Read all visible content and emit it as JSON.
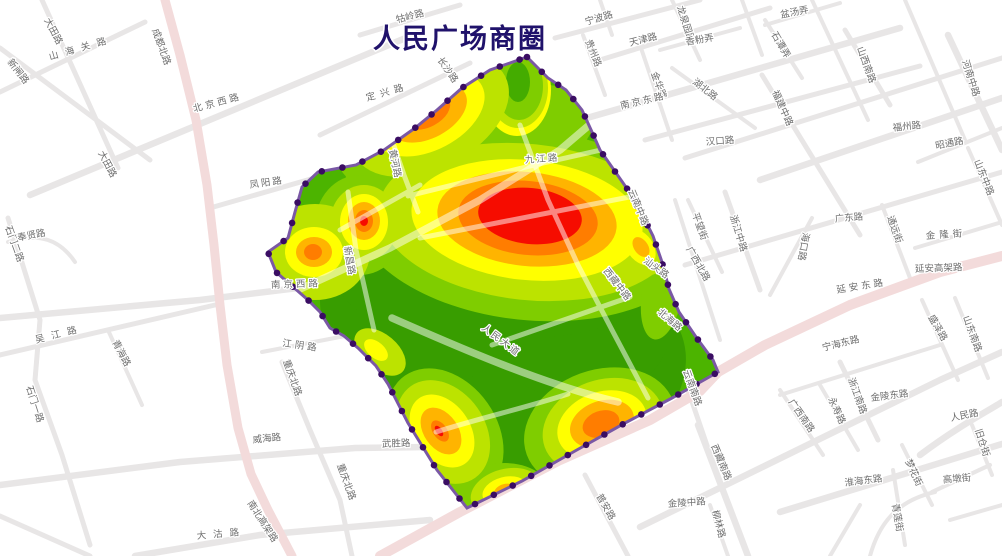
{
  "title": {
    "text": "人民广场商圈",
    "color": "#20126B"
  },
  "map": {
    "background": "#FFFFFF",
    "road_color": "#E8E6E6",
    "major_road_color": "#F3DBDB",
    "inner_road_color": "rgba(255,255,255,0.5)",
    "label_color": "#6E6E6E",
    "boundary": {
      "line_color": "#7A58A5",
      "vertex_color": "#3A0D63"
    },
    "heat": {
      "base": "#4CB400",
      "dark": "#389D00",
      "light": "#7FCD00",
      "yg": "#BCE300",
      "y": "#FFFF00",
      "o1": "#FFB400",
      "o2": "#FF7D00",
      "red": "#F60C00",
      "core_green": "#44AC00"
    },
    "labels": [
      {
        "t": "新闸路"
      },
      {
        "t": "大田路"
      },
      {
        "t": "山海关路"
      },
      {
        "t": "成都北路"
      },
      {
        "t": "北京西路"
      },
      {
        "t": "大田路"
      },
      {
        "t": "凤阳路"
      },
      {
        "t": "定兴路"
      },
      {
        "t": "长沙路"
      },
      {
        "t": "牯岭路"
      },
      {
        "t": "黄河路"
      },
      {
        "t": "九江路"
      },
      {
        "t": "宁波路"
      },
      {
        "t": "天津路"
      },
      {
        "t": "贵州路"
      },
      {
        "t": "金华路"
      },
      {
        "t": "南京东路"
      },
      {
        "t": "龙泉园路"
      },
      {
        "t": "香粉弄"
      },
      {
        "t": "盆汤弄"
      },
      {
        "t": "石潭弄"
      },
      {
        "t": "湖北路"
      },
      {
        "t": "山西南路"
      },
      {
        "t": "福建中路"
      },
      {
        "t": "汉口路"
      },
      {
        "t": "福州路"
      },
      {
        "t": "昭通路"
      },
      {
        "t": "河南中路"
      },
      {
        "t": "山东中路"
      },
      {
        "t": "云南中路"
      },
      {
        "t": "汕头路"
      },
      {
        "t": "西藏中路"
      },
      {
        "t": "北海路"
      },
      {
        "t": "广西北路"
      },
      {
        "t": "平望街"
      },
      {
        "t": "浙江中路"
      },
      {
        "t": "海口路"
      },
      {
        "t": "广东路"
      },
      {
        "t": "延安东路"
      },
      {
        "t": "延安高架路"
      },
      {
        "t": "通远街"
      },
      {
        "t": "金隆街"
      },
      {
        "t": "盛泽路"
      },
      {
        "t": "山东南路"
      },
      {
        "t": "新昌路"
      },
      {
        "t": "人民大道"
      },
      {
        "t": "南京西路"
      },
      {
        "t": "江阴路"
      },
      {
        "t": "吴江路"
      },
      {
        "t": "青海路"
      },
      {
        "t": "石门二路"
      },
      {
        "t": "奉贤路"
      },
      {
        "t": "石门一路"
      },
      {
        "t": "威海路"
      },
      {
        "t": "武胜路"
      },
      {
        "t": "重庆北路"
      },
      {
        "t": "重庆北路"
      },
      {
        "t": "大沽路"
      },
      {
        "t": "南北高架路"
      },
      {
        "t": "普安路"
      },
      {
        "t": "金陵中路"
      },
      {
        "t": "云南南路"
      },
      {
        "t": "西藏南路"
      },
      {
        "t": "柳林路"
      },
      {
        "t": "广西南路"
      },
      {
        "t": "永寿路"
      },
      {
        "t": "宁海东路"
      },
      {
        "t": "浙江南路"
      },
      {
        "t": "金陵东路"
      },
      {
        "t": "淮海东路"
      },
      {
        "t": "人民路"
      },
      {
        "t": "旧仓街"
      },
      {
        "t": "梦花街"
      },
      {
        "t": "青莲街"
      },
      {
        "t": "高墩街"
      }
    ]
  }
}
